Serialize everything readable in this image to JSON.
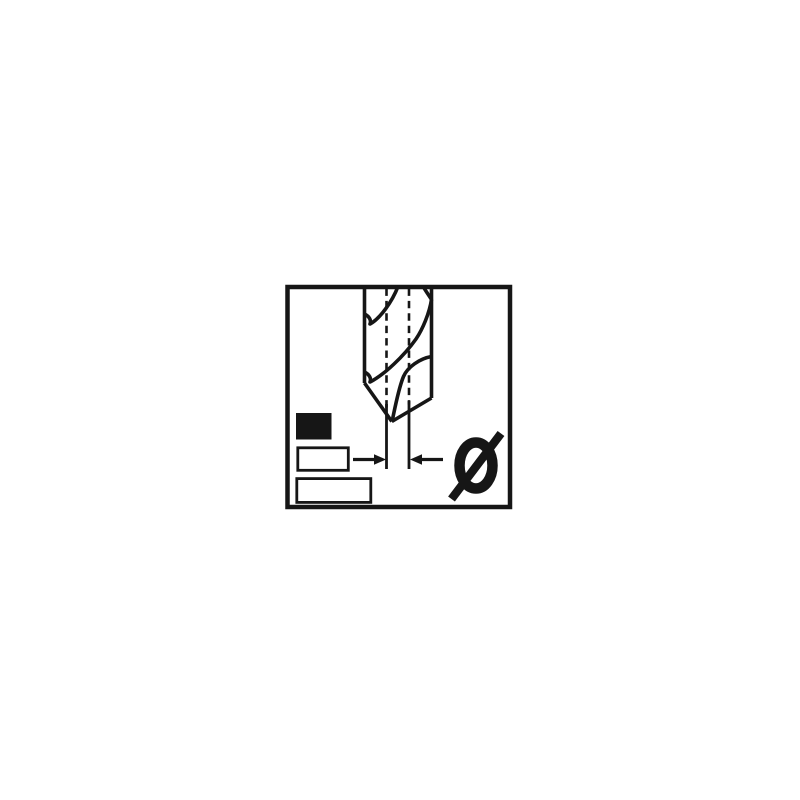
{
  "colors": {
    "bg": "#ffffff",
    "ink": "#161616"
  },
  "diagram": {
    "kind": "technical-pictogram",
    "subject": "twist-drill-bit-diameter",
    "symbol": "Ø",
    "icons": {
      "drill_bit": "twist-drill-bit-side-view-icon",
      "diameter_symbol": "Ø",
      "left_dimension_arrow": "→",
      "right_dimension_arrow": "←",
      "swatch_filled": "filled-rectangle-swatch",
      "swatch_outline_small": "outlined-rectangle-swatch",
      "swatch_outline_large": "outlined-rectangle-swatch"
    }
  }
}
